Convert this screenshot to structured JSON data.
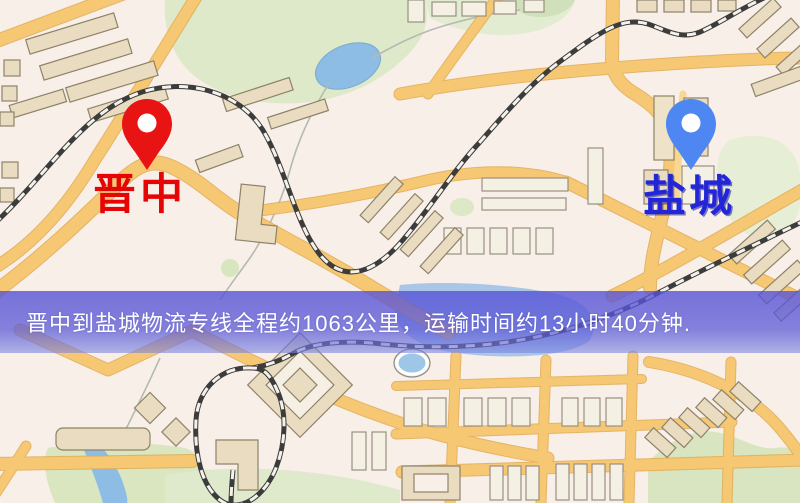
{
  "map": {
    "origin": {
      "label": "晋中",
      "pin_color": "#e81414",
      "label_color": "#e60505"
    },
    "destination": {
      "label": "盐城",
      "pin_color": "#4e86f2",
      "label_color": "#2325d8"
    },
    "banner": {
      "text": "晋中到盐城物流专线全程约1063公里，运输时间约13小时40分钟.",
      "background_color": "#5a57d4",
      "text_color": "#ffffff"
    },
    "palette": {
      "road": "#f6c873",
      "road_casing": "#e2a94f",
      "park_green": "#dde9c8",
      "water_blue": "#8dbde4",
      "railway_dark": "#3c3c3c",
      "background": "#f7efe8",
      "building_tan": "#e9dcc1"
    }
  }
}
